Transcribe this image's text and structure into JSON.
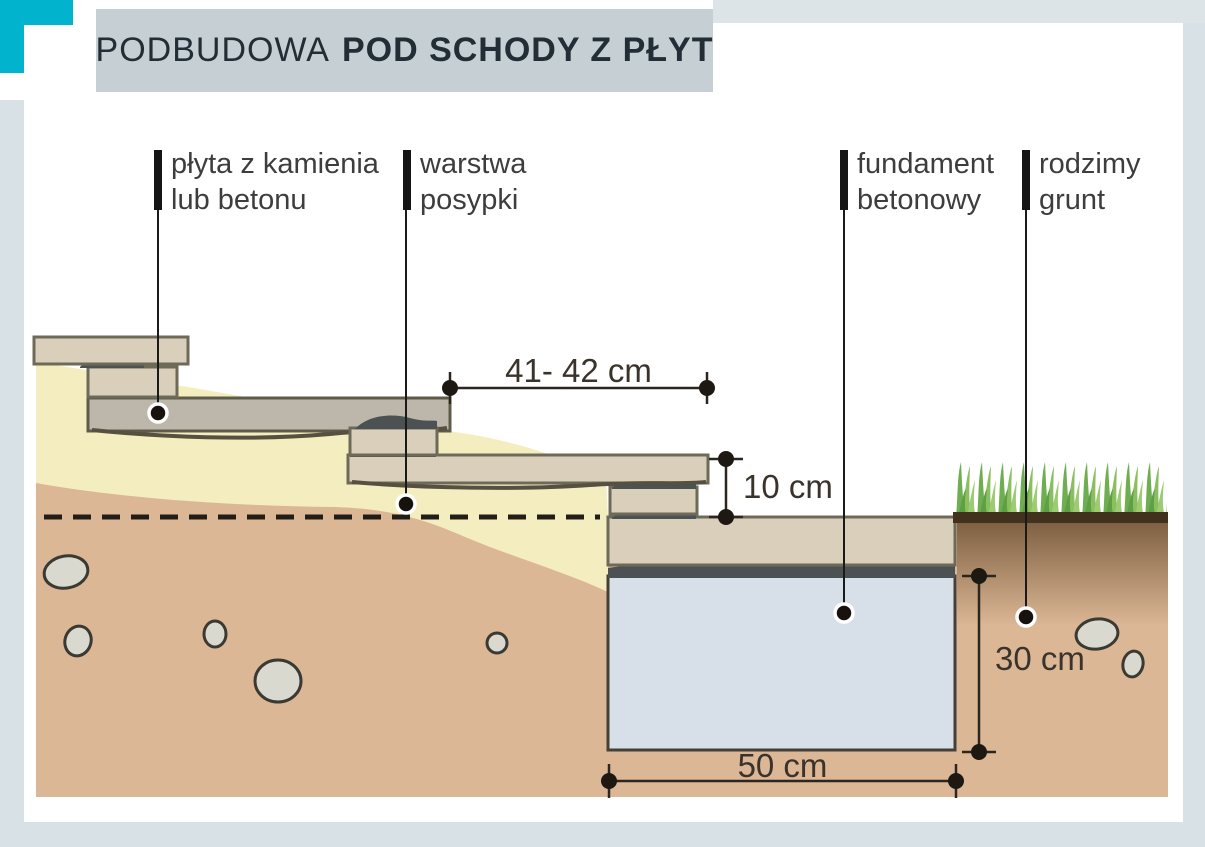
{
  "title": {
    "regular": "PODBUDOWA",
    "bold": "POD SCHODY Z PŁYT"
  },
  "callouts": [
    {
      "id": "slab",
      "line1": "płyta z kamienia",
      "line2": "lub betonu"
    },
    {
      "id": "bedding",
      "line1": "warstwa",
      "line2": "posypki"
    },
    {
      "id": "foundation",
      "line1": "fundament",
      "line2": "betonowy"
    },
    {
      "id": "native-soil",
      "line1": "rodzimy",
      "line2": "grunt"
    }
  ],
  "dimensions": {
    "tread_depth": "41- 42 cm",
    "step_height": "10 cm",
    "foundation_depth": "30 cm",
    "foundation_width": "50 cm"
  },
  "palette": {
    "accent_teal": "#01b3cc",
    "frame_blue": "#d8e1e5",
    "titlebar_gray": "#c6cfd4",
    "title_text": "#232d36",
    "sand_bedding": "#f3edbf",
    "soil_tan": "#dcb795",
    "slab_beige": "#dacfbb",
    "slab_gray": "#bdb7ab",
    "mortar_dark": "#4c5153",
    "foundation_concrete": "#d7e0e9",
    "stone_gray": "#d9d9d0",
    "grass_green": "#6fae50"
  }
}
